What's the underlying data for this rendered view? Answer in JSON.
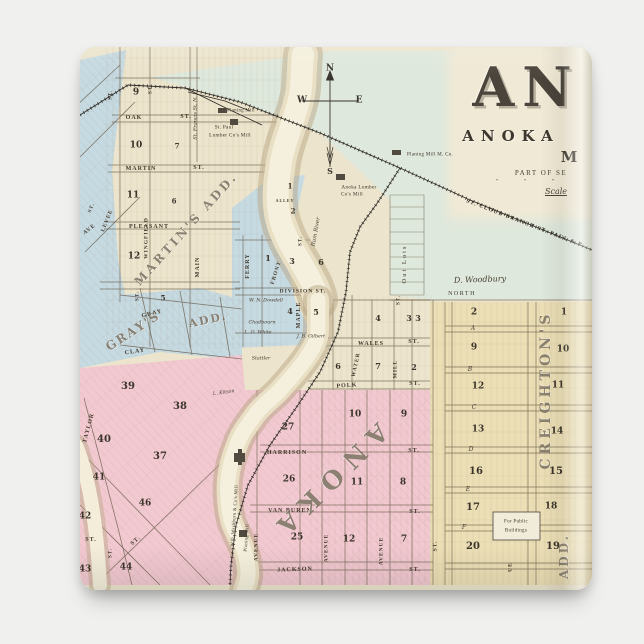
{
  "product": {
    "type": "square magnet product photo",
    "backdrop_color": "#f0f0ee"
  },
  "map": {
    "palette": {
      "paper": "#ece4cc",
      "title_panel": "#f0e9d5",
      "meadow_green": "#dfe8dc",
      "block_blue": "#c6dae2",
      "block_pink": "#f2c9d1",
      "block_yellow": "#ecdfb6",
      "river_fill": "#f5f0dd",
      "river_bank": "#b7a683",
      "line_ink": "#5f523f",
      "rail_ink": "#2f2b26"
    }
  },
  "title": {
    "big_word": "AN",
    "line2": "ANOKA",
    "line3": "M",
    "line4": "PART OF SE",
    "ditto": "″ ″ ″",
    "scale": "Scale"
  },
  "map_labels": [
    {
      "t": "N",
      "x": 330,
      "y": 69,
      "s": 9,
      "c": "cp",
      "n": "compass-n"
    },
    {
      "t": "W",
      "x": 302,
      "y": 101,
      "s": 9,
      "c": "cp",
      "n": "compass-w"
    },
    {
      "t": "E",
      "x": 359,
      "y": 101,
      "s": 9,
      "c": "cp",
      "n": "compass-e"
    },
    {
      "t": "S",
      "x": 330,
      "y": 171,
      "s": 8,
      "c": "cp",
      "n": "compass-s"
    },
    {
      "t": "OAK",
      "x": 134,
      "y": 118,
      "s": 6,
      "n": "street-label"
    },
    {
      "t": "ST.",
      "x": 186,
      "y": 117,
      "s": 6,
      "n": "street-label"
    },
    {
      "t": "MARTIN",
      "x": 141,
      "y": 169,
      "s": 6,
      "n": "street-label"
    },
    {
      "t": "ST.",
      "x": 199,
      "y": 168,
      "s": 6,
      "n": "street-label"
    },
    {
      "t": "PLEASANT",
      "x": 149,
      "y": 227,
      "s": 6,
      "n": "street-label"
    },
    {
      "t": "WINGFIELD",
      "x": 147,
      "y": 238,
      "s": 5.5,
      "r": -90,
      "n": "street-label"
    },
    {
      "t": "MAIN",
      "x": 198,
      "y": 267,
      "s": 6,
      "r": -90,
      "n": "street-label"
    },
    {
      "t": "ST.",
      "x": 111,
      "y": 95,
      "s": 5,
      "r": -90,
      "n": "street-label"
    },
    {
      "t": "ST.",
      "x": 151,
      "y": 89,
      "s": 5,
      "r": -90,
      "n": "street-label"
    },
    {
      "t": "St. Francis St. N.",
      "x": 196,
      "y": 118,
      "s": 5,
      "r": -90,
      "c": "sc",
      "n": "street-label"
    },
    {
      "t": "LEVEE",
      "x": 108,
      "y": 221,
      "s": 5.5,
      "r": -68,
      "n": "street-label"
    },
    {
      "t": "AVE",
      "x": 90,
      "y": 230,
      "s": 5.5,
      "r": -38,
      "n": "street-label"
    },
    {
      "t": "ST.",
      "x": 92,
      "y": 208,
      "s": 5,
      "r": -68,
      "n": "street-label"
    },
    {
      "t": "FERRY",
      "x": 248,
      "y": 266,
      "s": 6,
      "r": -90,
      "n": "street-label"
    },
    {
      "t": "FRONT",
      "x": 277,
      "y": 273,
      "s": 5.5,
      "r": -72,
      "n": "street-label"
    },
    {
      "t": "ST.",
      "x": 301,
      "y": 241,
      "s": 5,
      "r": -90,
      "n": "street-label"
    },
    {
      "t": "ALLEY",
      "x": 285,
      "y": 201,
      "s": 4,
      "n": "street-label"
    },
    {
      "t": "DIVISION ST.",
      "x": 303,
      "y": 292,
      "s": 5.5,
      "n": "street-label"
    },
    {
      "t": "MAPLE",
      "x": 299,
      "y": 315,
      "s": 6,
      "r": -90,
      "n": "street-label"
    },
    {
      "t": "GRAY",
      "x": 152,
      "y": 314,
      "s": 6,
      "r": -14,
      "n": "street-label"
    },
    {
      "t": "CLAY",
      "x": 135,
      "y": 352,
      "s": 6,
      "r": -8,
      "n": "street-label"
    },
    {
      "t": "ST.",
      "x": 138,
      "y": 296,
      "s": 5,
      "r": -90,
      "n": "street-label"
    },
    {
      "t": "TAYLOR",
      "x": 89,
      "y": 428,
      "s": 6,
      "r": -75,
      "n": "street-label"
    },
    {
      "t": "ST.",
      "x": 91,
      "y": 540,
      "s": 6,
      "n": "street-label"
    },
    {
      "t": "ST.",
      "x": 136,
      "y": 541,
      "s": 6,
      "r": -42,
      "n": "street-label"
    },
    {
      "t": "ST.",
      "x": 111,
      "y": 553,
      "s": 5,
      "r": -90,
      "n": "street-label"
    },
    {
      "t": "WALES",
      "x": 371,
      "y": 344,
      "s": 6,
      "n": "street-label"
    },
    {
      "t": "ST.",
      "x": 414,
      "y": 342,
      "s": 6,
      "n": "street-label"
    },
    {
      "t": "POLK",
      "x": 347,
      "y": 386,
      "s": 6,
      "r": -4,
      "n": "street-label"
    },
    {
      "t": "ST.",
      "x": 415,
      "y": 384,
      "s": 6,
      "n": "street-label"
    },
    {
      "t": "WATER",
      "x": 357,
      "y": 365,
      "s": 5.5,
      "r": -78,
      "n": "street-label"
    },
    {
      "t": "MILL",
      "x": 396,
      "y": 369,
      "s": 5.5,
      "r": -90,
      "n": "street-label"
    },
    {
      "t": "ST.",
      "x": 399,
      "y": 300,
      "s": 5,
      "r": -90,
      "n": "street-label"
    },
    {
      "t": "HARRISON",
      "x": 287,
      "y": 453,
      "s": 6,
      "n": "street-label"
    },
    {
      "t": "ST.",
      "x": 414,
      "y": 451,
      "s": 6,
      "n": "street-label"
    },
    {
      "t": "VAN BUREN",
      "x": 290,
      "y": 511,
      "s": 6,
      "n": "street-label"
    },
    {
      "t": "ST.",
      "x": 415,
      "y": 512,
      "s": 6,
      "n": "street-label"
    },
    {
      "t": "JACKSON",
      "x": 295,
      "y": 570,
      "s": 6,
      "r": -2,
      "n": "street-label"
    },
    {
      "t": "ST.",
      "x": 415,
      "y": 570,
      "s": 6,
      "n": "street-label"
    },
    {
      "t": "AVENUE",
      "x": 257,
      "y": 547,
      "s": 5.5,
      "r": -90,
      "n": "street-label"
    },
    {
      "t": "AVENUE",
      "x": 327,
      "y": 548,
      "s": 5.5,
      "r": -90,
      "n": "street-label"
    },
    {
      "t": "AVENUE",
      "x": 382,
      "y": 551,
      "s": 5.5,
      "r": -90,
      "n": "street-label"
    },
    {
      "t": "ST.",
      "x": 436,
      "y": 546,
      "s": 5.5,
      "r": -90,
      "n": "street-label"
    },
    {
      "t": "UE",
      "x": 511,
      "y": 567,
      "s": 5.5,
      "r": -90,
      "n": "street-label"
    },
    {
      "t": "A",
      "x": 473,
      "y": 329,
      "s": 6,
      "c": "sc",
      "n": "street-label"
    },
    {
      "t": "B",
      "x": 470,
      "y": 370,
      "s": 6,
      "c": "sc",
      "n": "street-label"
    },
    {
      "t": "C",
      "x": 474,
      "y": 408,
      "s": 6,
      "c": "sc",
      "n": "street-label"
    },
    {
      "t": "D",
      "x": 471,
      "y": 450,
      "s": 6,
      "c": "sc",
      "n": "street-label"
    },
    {
      "t": "E",
      "x": 468,
      "y": 490,
      "s": 6,
      "c": "sc",
      "n": "street-label"
    },
    {
      "t": "F",
      "x": 464,
      "y": 528,
      "s": 6,
      "c": "sc",
      "n": "street-label"
    },
    {
      "t": "Out Lots",
      "x": 405,
      "y": 264,
      "s": 6.5,
      "r": -90,
      "c": "pl",
      "ls": 2,
      "n": "area-label"
    },
    {
      "t": "D. Woodbury",
      "x": 480,
      "y": 280,
      "s": 8,
      "c": "sc",
      "r": -2,
      "n": "owner-label"
    },
    {
      "t": "NORTH",
      "x": 462,
      "y": 294,
      "s": 6,
      "c": "pl",
      "ls": 1.5,
      "n": "area-label"
    },
    {
      "t": "W. N. Dowdell",
      "x": 266,
      "y": 302,
      "s": 4.8,
      "c": "sc",
      "n": "owner-label"
    },
    {
      "t": "Chadbourn",
      "x": 262,
      "y": 324,
      "s": 4.8,
      "c": "sc",
      "n": "owner-label"
    },
    {
      "t": "L. O. White",
      "x": 258,
      "y": 334,
      "s": 4.8,
      "c": "sc",
      "n": "owner-label"
    },
    {
      "t": "J. B. Gilbert",
      "x": 311,
      "y": 338,
      "s": 4.8,
      "c": "sc",
      "n": "owner-label"
    },
    {
      "t": "Stattler",
      "x": 261,
      "y": 360,
      "s": 4.8,
      "c": "sc",
      "n": "owner-label"
    },
    {
      "t": "L. Kitson",
      "x": 224,
      "y": 394,
      "s": 4.8,
      "c": "sc",
      "r": -8,
      "n": "owner-label"
    },
    {
      "t": "Rum River",
      "x": 317,
      "y": 232,
      "s": 5.5,
      "c": "sc",
      "r": -80,
      "n": "river-label"
    },
    {
      "t": "Planing Mill",
      "x": 241,
      "y": 112,
      "s": 4.8,
      "c": "pl",
      "n": "mill-label"
    },
    {
      "t": "St. Paul",
      "x": 224,
      "y": 128,
      "s": 5.2,
      "c": "pl",
      "n": "mill-label"
    },
    {
      "t": "Lumber Co's Mill",
      "x": 230,
      "y": 136,
      "s": 5.2,
      "c": "pl",
      "n": "mill-label"
    },
    {
      "t": "Anoka Lumber",
      "x": 359,
      "y": 188,
      "s": 5.2,
      "c": "pl",
      "n": "mill-label"
    },
    {
      "t": "Co's Mill",
      "x": 352,
      "y": 195,
      "s": 5.2,
      "c": "pl",
      "n": "mill-label"
    },
    {
      "t": "Planing Mill M. Co.",
      "x": 430,
      "y": 155,
      "s": 5,
      "c": "pl",
      "n": "mill-label"
    },
    {
      "t": "W.D. Washburn & Co's Mill",
      "x": 236,
      "y": 516,
      "s": 4.8,
      "c": "pl",
      "r": -86,
      "n": "mill-label"
    },
    {
      "t": "Planing Mill",
      "x": 248,
      "y": 538,
      "s": 4.8,
      "c": "pl",
      "r": -86,
      "n": "mill-label"
    },
    {
      "t": "For Public",
      "x": 516,
      "y": 522,
      "s": 5,
      "c": "pl",
      "n": "public-buildings-label"
    },
    {
      "t": "Buildings",
      "x": 516,
      "y": 531,
      "s": 5,
      "c": "pl",
      "n": "public-buildings-label"
    },
    {
      "t": "ST. CLOUD BRANCH ST. PAUL & P",
      "x": 524,
      "y": 224,
      "s": 5.5,
      "c": "rr",
      "r": 21,
      "ls": 1.2,
      "n": "railroad-label"
    },
    {
      "t": "MARTIN'S ADD.",
      "x": 186,
      "y": 229,
      "s": 12,
      "c": "ol",
      "r": -48,
      "ls": 3,
      "n": "addition-label"
    },
    {
      "t": "GRAY'S",
      "x": 133,
      "y": 331,
      "s": 12,
      "c": "ol",
      "r": -33,
      "ls": 2,
      "n": "addition-label"
    },
    {
      "t": "ADD.",
      "x": 208,
      "y": 320,
      "s": 11,
      "c": "ol",
      "r": -12,
      "ls": 2,
      "n": "addition-label"
    },
    {
      "t": "ANOKA",
      "x": 329,
      "y": 482,
      "s": 25,
      "c": "ol",
      "r": 135,
      "ls": 10,
      "n": "town-name-label"
    },
    {
      "t": "CREIGHTON'S",
      "x": 546,
      "y": 390,
      "s": 14,
      "c": "ol",
      "r": -90,
      "ls": 4,
      "n": "addition-label"
    },
    {
      "t": "ADD.",
      "x": 564,
      "y": 556,
      "s": 12,
      "c": "ol",
      "r": -90,
      "ls": 3,
      "n": "addition-label"
    },
    {
      "t": "9",
      "x": 136,
      "y": 93,
      "s": 9,
      "c": "bn",
      "n": "block-number"
    },
    {
      "t": "10",
      "x": 136,
      "y": 146,
      "s": 9,
      "c": "bn",
      "n": "block-number"
    },
    {
      "t": "7",
      "x": 177,
      "y": 146,
      "s": 7,
      "c": "bn",
      "n": "block-number"
    },
    {
      "t": "11",
      "x": 133,
      "y": 196,
      "s": 9,
      "c": "bn",
      "n": "block-number"
    },
    {
      "t": "6",
      "x": 174,
      "y": 201,
      "s": 7,
      "c": "bn",
      "n": "block-number"
    },
    {
      "t": "12",
      "x": 134,
      "y": 257,
      "s": 9,
      "c": "bn",
      "n": "block-number"
    },
    {
      "t": "5",
      "x": 163,
      "y": 298,
      "s": 7,
      "c": "bn",
      "n": "block-number"
    },
    {
      "t": "1",
      "x": 290,
      "y": 186,
      "s": 7,
      "c": "bn",
      "n": "block-number"
    },
    {
      "t": "2",
      "x": 293,
      "y": 211,
      "s": 7,
      "c": "bn",
      "n": "block-number"
    },
    {
      "t": "1",
      "x": 268,
      "y": 258,
      "s": 8,
      "c": "bn",
      "n": "block-number"
    },
    {
      "t": "3",
      "x": 292,
      "y": 261,
      "s": 8,
      "c": "bn",
      "n": "block-number"
    },
    {
      "t": "6",
      "x": 321,
      "y": 262,
      "s": 8,
      "c": "bn",
      "n": "block-number"
    },
    {
      "t": "4",
      "x": 290,
      "y": 311,
      "s": 8,
      "c": "bn",
      "n": "block-number"
    },
    {
      "t": "5",
      "x": 316,
      "y": 312,
      "s": 8,
      "c": "bn",
      "n": "block-number"
    },
    {
      "t": "39",
      "x": 128,
      "y": 387,
      "s": 10,
      "c": "bn",
      "n": "block-number"
    },
    {
      "t": "38",
      "x": 180,
      "y": 407,
      "s": 10,
      "c": "bn",
      "n": "block-number"
    },
    {
      "t": "40",
      "x": 104,
      "y": 440,
      "s": 10,
      "c": "bn",
      "n": "block-number"
    },
    {
      "t": "37",
      "x": 160,
      "y": 457,
      "s": 10,
      "c": "bn",
      "n": "block-number"
    },
    {
      "t": "41",
      "x": 99,
      "y": 478,
      "s": 9,
      "c": "bn",
      "n": "block-number"
    },
    {
      "t": "46",
      "x": 145,
      "y": 504,
      "s": 9,
      "c": "bn",
      "n": "block-number"
    },
    {
      "t": "42",
      "x": 85,
      "y": 517,
      "s": 9,
      "c": "bn",
      "n": "block-number"
    },
    {
      "t": "43",
      "x": 85,
      "y": 570,
      "s": 9,
      "c": "bn",
      "n": "block-number"
    },
    {
      "t": "44",
      "x": 126,
      "y": 568,
      "s": 9,
      "c": "bn",
      "n": "block-number"
    },
    {
      "t": "4",
      "x": 378,
      "y": 318,
      "s": 8,
      "c": "bn",
      "n": "block-number"
    },
    {
      "t": "3",
      "x": 409,
      "y": 318,
      "s": 8,
      "c": "bn",
      "n": "block-number"
    },
    {
      "t": "6",
      "x": 338,
      "y": 366,
      "s": 8,
      "c": "bn",
      "n": "block-number"
    },
    {
      "t": "7",
      "x": 378,
      "y": 366,
      "s": 8,
      "c": "bn",
      "n": "block-number"
    },
    {
      "t": "2",
      "x": 414,
      "y": 367,
      "s": 8,
      "c": "bn",
      "n": "block-number"
    },
    {
      "t": "10",
      "x": 355,
      "y": 415,
      "s": 9,
      "c": "bn",
      "n": "block-number"
    },
    {
      "t": "9",
      "x": 404,
      "y": 415,
      "s": 9,
      "c": "bn",
      "n": "block-number"
    },
    {
      "t": "27",
      "x": 288,
      "y": 428,
      "s": 9,
      "c": "bn",
      "n": "block-number"
    },
    {
      "t": "26",
      "x": 289,
      "y": 480,
      "s": 9,
      "c": "bn",
      "n": "block-number"
    },
    {
      "t": "11",
      "x": 357,
      "y": 483,
      "s": 9,
      "c": "bn",
      "n": "block-number"
    },
    {
      "t": "8",
      "x": 403,
      "y": 483,
      "s": 9,
      "c": "bn",
      "n": "block-number"
    },
    {
      "t": "25",
      "x": 297,
      "y": 538,
      "s": 9,
      "c": "bn",
      "n": "block-number"
    },
    {
      "t": "12",
      "x": 349,
      "y": 540,
      "s": 9,
      "c": "bn",
      "n": "block-number"
    },
    {
      "t": "7",
      "x": 404,
      "y": 540,
      "s": 9,
      "c": "bn",
      "n": "block-number"
    },
    {
      "t": "3",
      "x": 418,
      "y": 318,
      "s": 8,
      "c": "bn",
      "n": "block-number"
    },
    {
      "t": "2",
      "x": 474,
      "y": 313,
      "s": 9,
      "c": "bn",
      "n": "block-number"
    },
    {
      "t": "1",
      "x": 564,
      "y": 313,
      "s": 9,
      "c": "bn",
      "n": "block-number"
    },
    {
      "t": "9",
      "x": 474,
      "y": 348,
      "s": 9,
      "c": "bn",
      "n": "block-number"
    },
    {
      "t": "10",
      "x": 563,
      "y": 350,
      "s": 9,
      "c": "bn",
      "n": "block-number"
    },
    {
      "t": "12",
      "x": 478,
      "y": 387,
      "s": 9,
      "c": "bn",
      "n": "block-number"
    },
    {
      "t": "11",
      "x": 558,
      "y": 386,
      "s": 9,
      "c": "bn",
      "n": "block-number"
    },
    {
      "t": "13",
      "x": 478,
      "y": 430,
      "s": 9,
      "c": "bn",
      "n": "block-number"
    },
    {
      "t": "14",
      "x": 557,
      "y": 432,
      "s": 9,
      "c": "bn",
      "n": "block-number"
    },
    {
      "t": "16",
      "x": 476,
      "y": 472,
      "s": 10,
      "c": "bn",
      "n": "block-number"
    },
    {
      "t": "15",
      "x": 556,
      "y": 472,
      "s": 10,
      "c": "bn",
      "n": "block-number"
    },
    {
      "t": "17",
      "x": 473,
      "y": 508,
      "s": 10,
      "c": "bn",
      "n": "block-number"
    },
    {
      "t": "18",
      "x": 551,
      "y": 507,
      "s": 9,
      "c": "bn",
      "n": "block-number"
    },
    {
      "t": "20",
      "x": 473,
      "y": 547,
      "s": 10,
      "c": "bn",
      "n": "block-number"
    },
    {
      "t": "19",
      "x": 553,
      "y": 547,
      "s": 10,
      "c": "bn",
      "n": "block-number"
    }
  ]
}
